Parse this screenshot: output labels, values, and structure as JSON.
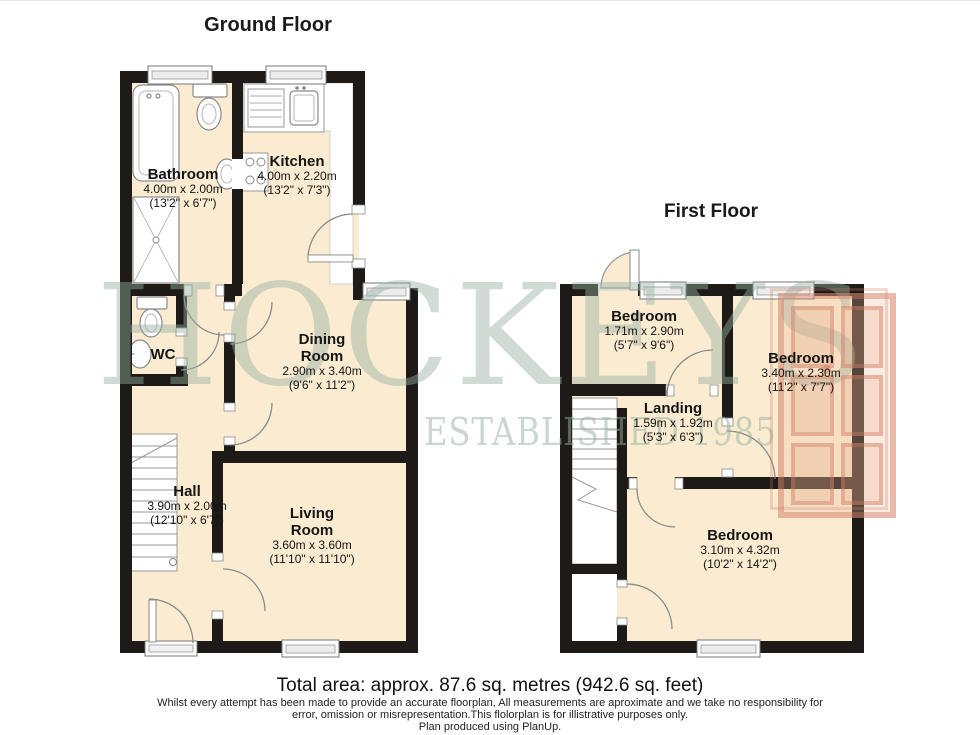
{
  "titles": {
    "ground": "Ground Floor",
    "first": "First Floor"
  },
  "watermark": {
    "name": "HOCKEYS",
    "tagline": "ESTABLISHED 1985"
  },
  "ground": {
    "rooms": [
      {
        "id": "bathroom",
        "name": "Bathroom",
        "metric": "4.00m x 2.00m",
        "imperial": "(13'2\" x 6'7\")"
      },
      {
        "id": "kitchen",
        "name": "Kitchen",
        "metric": "4.00m x 2.20m",
        "imperial": "(13'2\" x 7'3\")"
      },
      {
        "id": "wc",
        "name": "WC"
      },
      {
        "id": "dining",
        "name": "Dining Room",
        "metric": "2.90m x 3.40m",
        "imperial": "(9'6\" x 11'2\")"
      },
      {
        "id": "hall",
        "name": "Hall",
        "metric": "3.90m x 2.00m",
        "imperial": "(12'10\" x 6'7\")"
      },
      {
        "id": "living",
        "name": "Living Room",
        "metric": "3.60m x 3.60m",
        "imperial": "(11'10\" x 11'10\")"
      }
    ]
  },
  "first": {
    "rooms": [
      {
        "id": "bedroom-1",
        "name": "Bedroom",
        "metric": "1.71m x 2.90m",
        "imperial": "(5'7\" x 9'6\")"
      },
      {
        "id": "bedroom-2",
        "name": "Bedroom",
        "metric": "3.40m x 2.30m",
        "imperial": "(11'2\" x 7'7\")"
      },
      {
        "id": "landing",
        "name": "Landing",
        "metric": "1.59m x 1.92m",
        "imperial": "(5'3\" x 6'3\")"
      },
      {
        "id": "bedroom-3",
        "name": "Bedroom",
        "metric": "3.10m x 4.32m",
        "imperial": "(10'2\" x 14'2\")"
      }
    ]
  },
  "footer": {
    "total_area": "Total area: approx. 87.6 sq. metres (942.6 sq. feet)",
    "disclaimer1": "Whilst every attempt has been made to provide an accurate floorplan, All measurements are aproximate and we take no responsibility for",
    "disclaimer2": "error, omission or misrepresentation.This flolorplan is for illistrative purposes only.",
    "disclaimer3": "Plan produced using PlanUp."
  },
  "colors": {
    "room_fill": "#fbecd1",
    "wall": "#1d1a17",
    "watermark_text": "#c9d8d0",
    "watermark_door": "#d98f74"
  }
}
